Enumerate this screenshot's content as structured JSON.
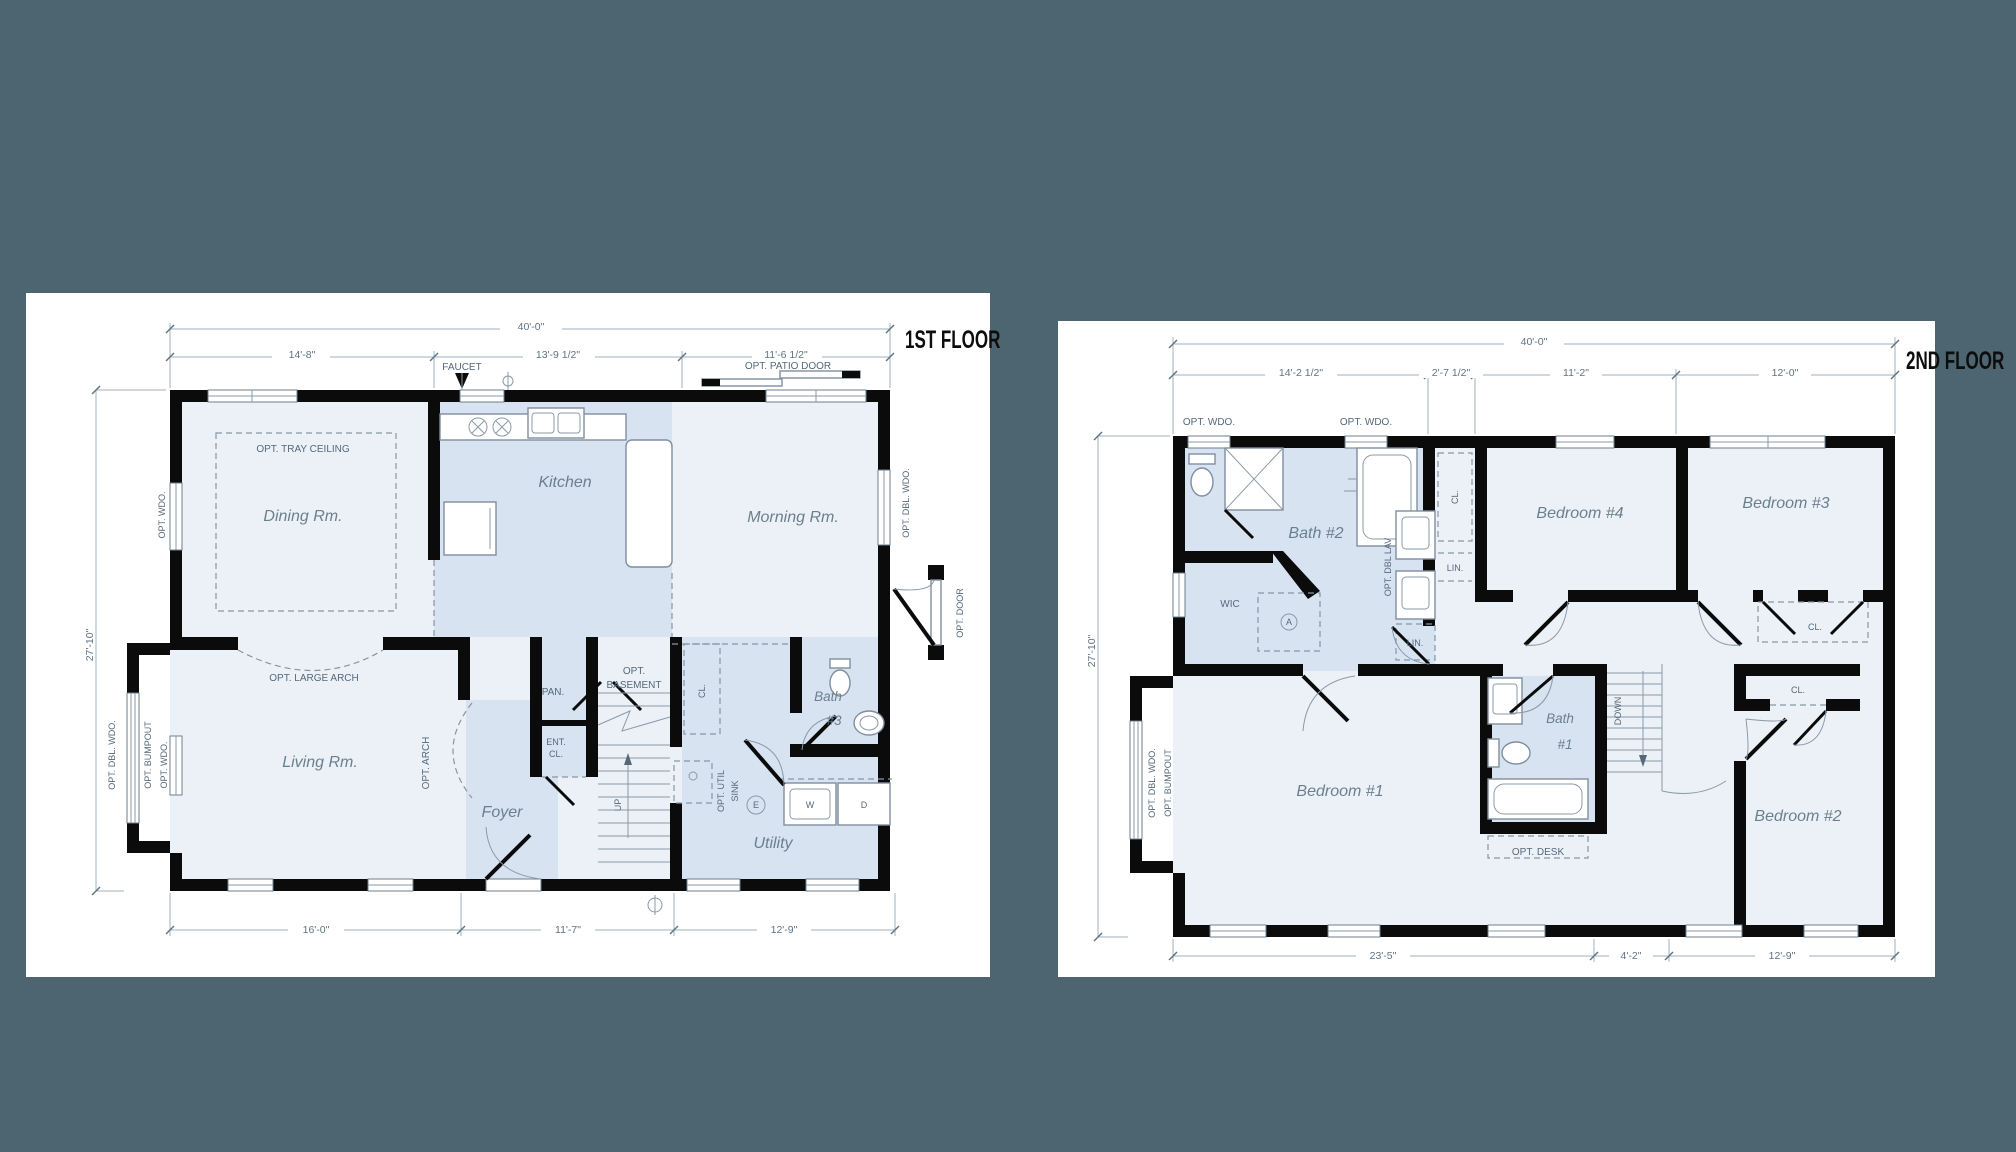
{
  "colors": {
    "background": "#4c6570",
    "paper": "#ffffff",
    "wall": "#0b0b0b",
    "room_light": "#ecf1f7",
    "room_blue": "#d7e3f1",
    "ink": "#5f7383"
  },
  "floor1": {
    "title": "1ST FLOOR",
    "dims": {
      "overall": "40'-0\"",
      "top1": "14'-8\"",
      "top2": "13'-9 1/2\"",
      "top3": "11'-6 1/2\"",
      "left": "27'-10\"",
      "bot1": "16'-0\"",
      "bot2": "11'-7\"",
      "bot3": "12'-9\""
    },
    "rooms": {
      "dining": "Dining Rm.",
      "kitchen": "Kitchen",
      "morning": "Morning Rm.",
      "living": "Living Rm.",
      "foyer": "Foyer",
      "utility": "Utility"
    },
    "labels": {
      "tray": "OPT. TRAY CEILING",
      "large_arch": "OPT. LARGE ARCH",
      "opt_arch": "OPT. ARCH",
      "faucet": "FAUCET",
      "patio": "OPT. PATIO DOOR",
      "opt_wdo": "OPT. WDO.",
      "opt_dbl_wdo": "OPT. DBL. WDO.",
      "opt_bumpout": "OPT. BUMPOUT",
      "opt_door": "OPT. DOOR",
      "pan": "PAN.",
      "ent": "ENT.",
      "cl": "CL.",
      "opt": "OPT.",
      "basement": "BASEMENT",
      "up": "UP",
      "opt_util": "OPT. UTIL",
      "sink": "SINK",
      "washer": "W",
      "dryer": "D",
      "electric": "E",
      "bath": "Bath",
      "bath_no": "#3"
    }
  },
  "floor2": {
    "title": "2ND FLOOR",
    "dims": {
      "overall": "40'-0\"",
      "top1": "14'-2 1/2\"",
      "top2": "2'-7 1/2\"",
      "top3": "11'-2\"",
      "top4": "12'-0\"",
      "left": "27'-10\"",
      "bot1": "23'-5\"",
      "bot2": "4'-2\"",
      "bot3": "12'-9\""
    },
    "rooms": {
      "bath2": "Bath #2",
      "bed4": "Bedroom #4",
      "bed3": "Bedroom #3",
      "bed1": "Bedroom #1",
      "bed2": "Bedroom #2"
    },
    "labels": {
      "opt_wdo": "OPT. WDO.",
      "opt_dbl_wdo": "OPT. DBL. WDO.",
      "opt_bumpout": "OPT. BUMPOUT",
      "opt_dbl_lav": "OPT. DBL LAV",
      "lin": "LIN.",
      "cl": "CL.",
      "wic": "WIC",
      "attic": "A",
      "bath": "Bath",
      "bath_no": "#1",
      "down": "DOWN",
      "opt_desk": "OPT. DESK"
    }
  }
}
